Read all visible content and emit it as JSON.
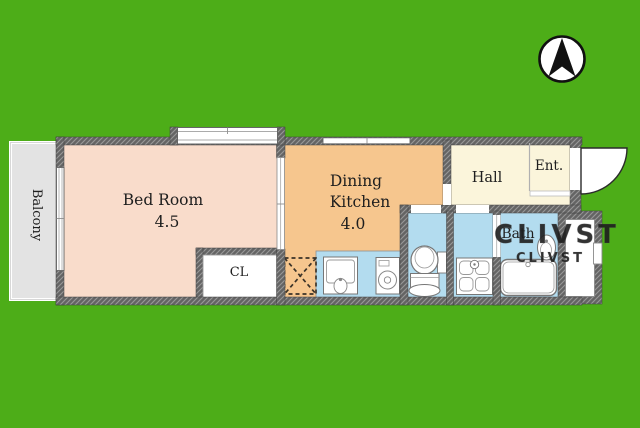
{
  "colors": {
    "background": "#4DAD18",
    "bedroom": "#F9DCCB",
    "dining_kitchen": "#F6C68E",
    "hall": "#FBF5DB",
    "wet_area": "#B3DCEF",
    "balcony": "#E3E3E3",
    "wall": "#666666",
    "fixture_white": "#FFFFFF"
  },
  "rooms": {
    "bedroom": {
      "label": "Bed Room",
      "area": "4.5"
    },
    "dining_kitchen": {
      "label_line1": "Dining",
      "label_line2": "Kitchen",
      "area": "4.0"
    },
    "hall": {
      "label": "Hall"
    },
    "entrance": {
      "label": "Ent."
    },
    "bath": {
      "label": "Bath"
    },
    "closet": {
      "label": "CL"
    },
    "balcony": {
      "label": "Balcony"
    }
  },
  "icons": {
    "compass": "north-compass-icon",
    "entrance_door": "door-swing-arc-icon",
    "refrigerator_space": "crossed-dashed-box-icon",
    "kitchen_sink": "kitchen-sink-icon",
    "washing_machine": "washing-machine-icon",
    "toilet": "toilet-icon",
    "washbasin": "washbasin-icon",
    "bathtub": "bathtub-icon",
    "bath_sink": "oval-sink-icon"
  },
  "watermark": {
    "line1": "CLIVST",
    "line2": "CLIVST"
  }
}
